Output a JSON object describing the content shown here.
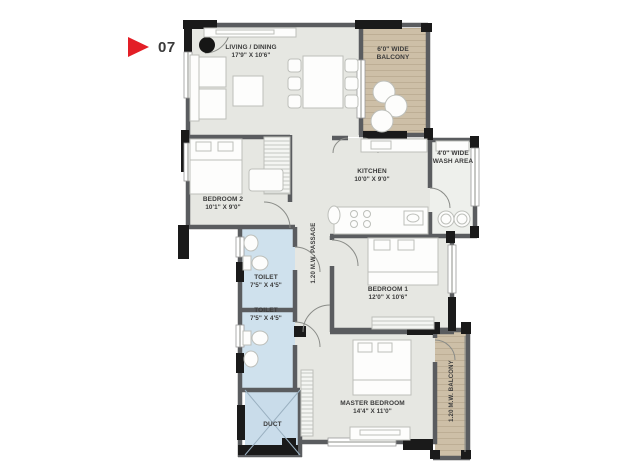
{
  "marker": {
    "number": "07"
  },
  "plan": {
    "living": {
      "name": "LIVING / DINING",
      "dims": "17'9\" X 10'6\""
    },
    "balcony_top": {
      "line1": "6'0\" WIDE",
      "line2": "BALCONY"
    },
    "kitchen": {
      "name": "KITCHEN",
      "dims": "10'0\" X 9'0\""
    },
    "wash": {
      "line1": "4'0\" WIDE",
      "line2": "WASH AREA"
    },
    "bedroom2": {
      "name": "BEDROOM 2",
      "dims": "10'1\" X 9'0\""
    },
    "toilet1": {
      "name": "TOILET",
      "dims": "7'5\" X 4'5\""
    },
    "toilet2": {
      "name": "TOILET",
      "dims": "7'5\" X 4'5\""
    },
    "passage": {
      "name": "1.20 M.W. PASSAGE"
    },
    "bedroom1": {
      "name": "BEDROOM 1",
      "dims": "12'0\" X 10'6\""
    },
    "master": {
      "name": "MASTER BEDROOM",
      "dims": "14'4\" X 11'0\""
    },
    "balcony_right": {
      "name": "1.20 M.W. BALCONY"
    },
    "duct": {
      "name": "DUCT"
    }
  },
  "colors": {
    "floor": "#e6e7e2",
    "balcony_tan": "#cdbfa7",
    "wet_blue": "#cfe1ed",
    "wall_dark": "#1a1a1a",
    "wall_gray": "#5a5c5f",
    "marker_red": "#e31e26",
    "text": "#3b3b3b"
  }
}
